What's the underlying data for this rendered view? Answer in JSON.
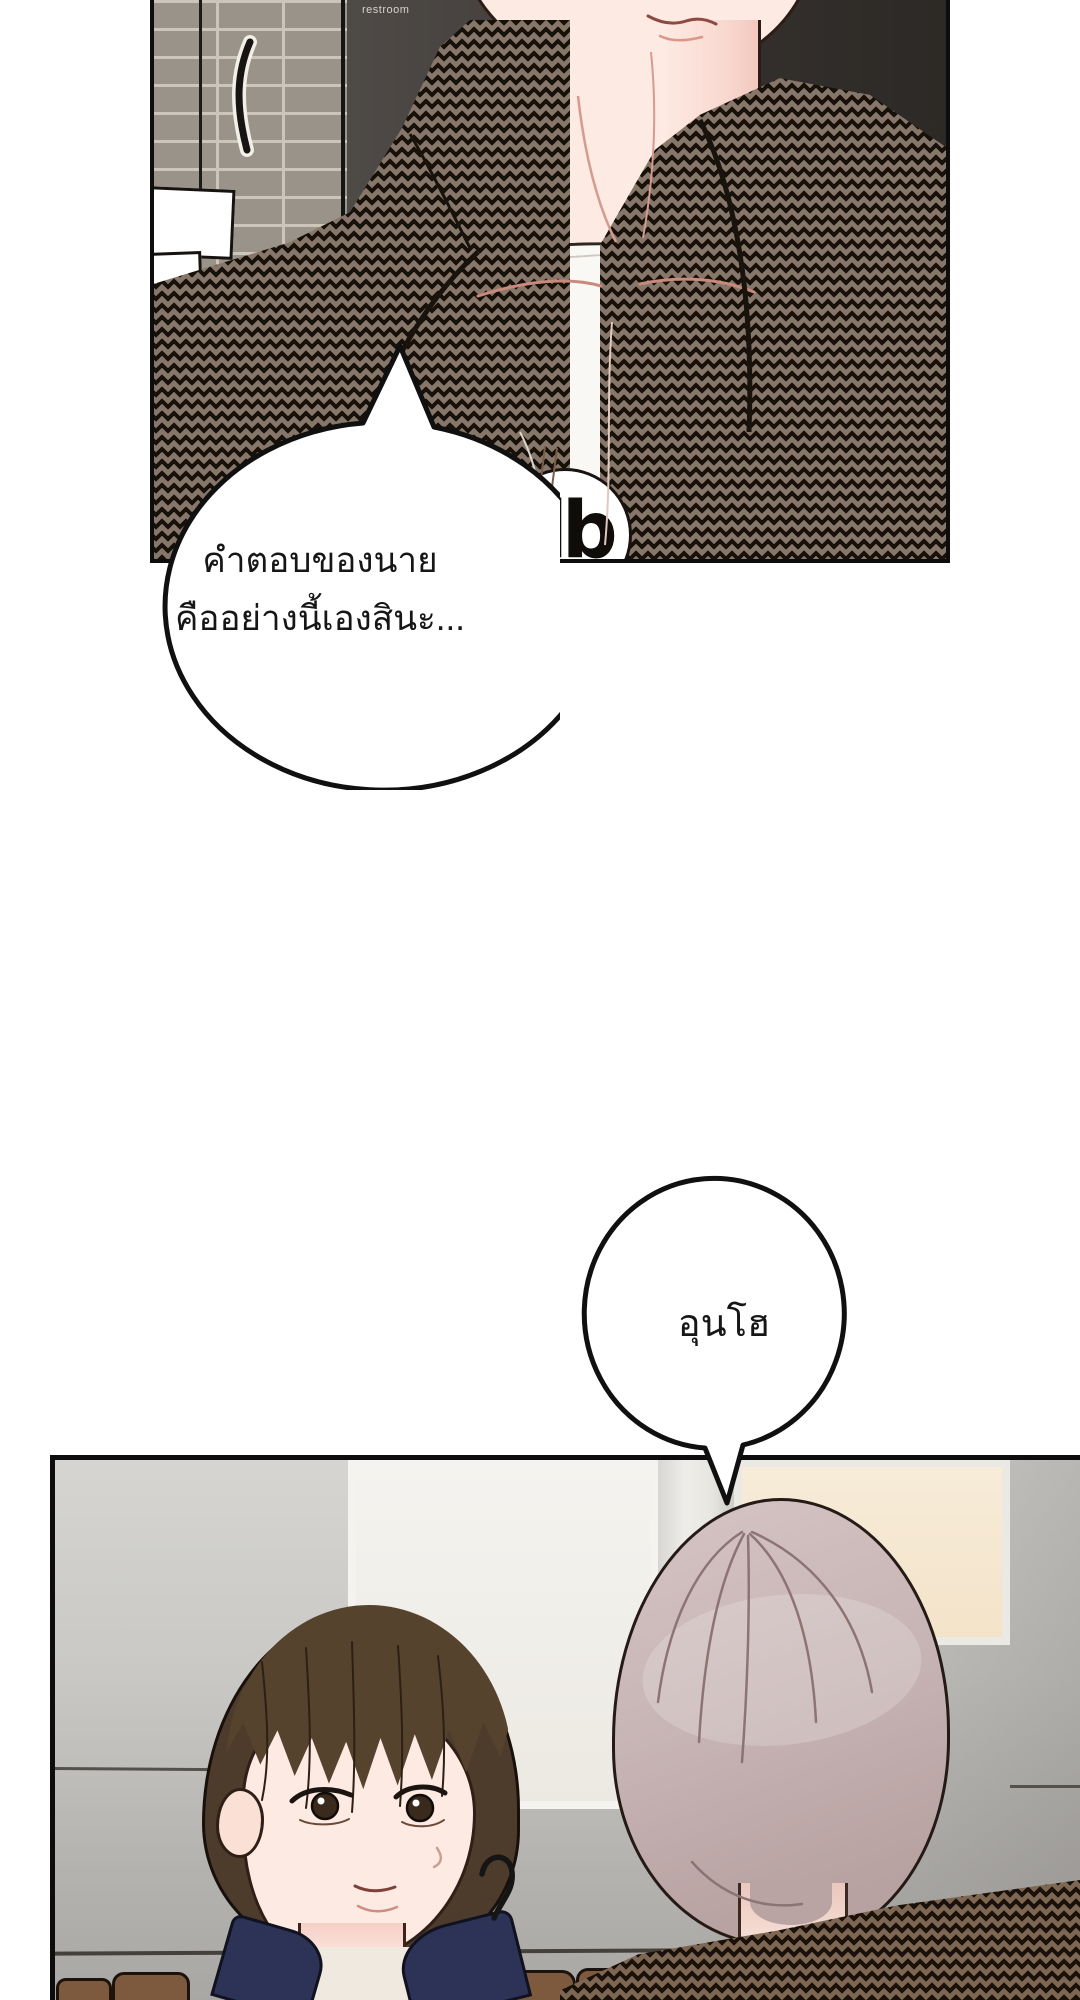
{
  "page": {
    "background": "#ffffff",
    "type": "webtoon-comic-page"
  },
  "panel1": {
    "sign_label": "restroom",
    "shirt_logo": "db",
    "speech_bubble": {
      "line1": "คำตอบของนาย",
      "line2": "คืออย่างนี้เองสินะ..."
    }
  },
  "panel2": {
    "speech_bubble": {
      "text": "อุนโฮ"
    }
  },
  "colors": {
    "outline": "#16100b",
    "houndstooth_base": "#87776a",
    "houndstooth_dark": "#17110a",
    "skin": "#fdeae3",
    "skin_shadow": "#f6cfc6",
    "hair_brown": "#54422f",
    "hair_mauve": "#c7b4b4",
    "navy_collar": "#2c3356",
    "brick": "#9a938a",
    "mortar": "#ccc5b9",
    "dark_wall": "#3a3532",
    "wall_gray": "#c7c6c3",
    "window_cream": "#f6ecd9",
    "window_white": "#f2f1ed",
    "couch_brown": "#7d5a3d"
  }
}
